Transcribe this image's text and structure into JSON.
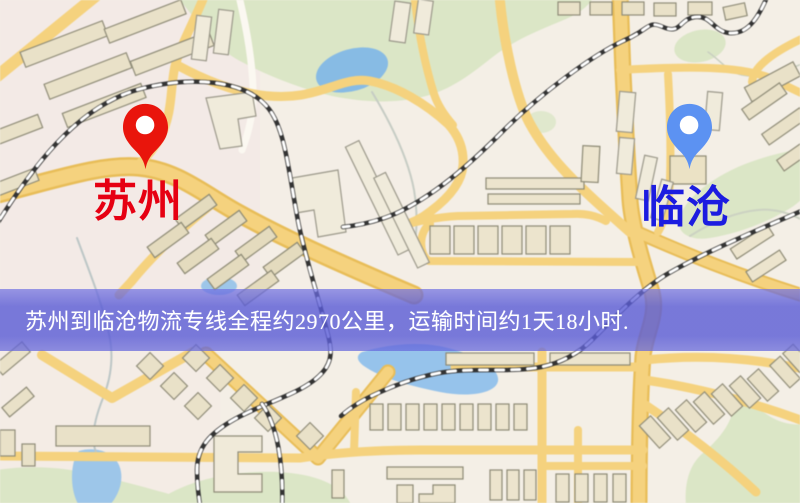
{
  "map": {
    "kind": "road-map",
    "colors": {
      "background": "#f4efe6",
      "road": "#f6d27b",
      "road_casing": "#e9bd55",
      "minor_road": "#fbf8f1",
      "park": "#dbe6c5",
      "water": "#8fc0e8",
      "building_fill": "#e9e1c7",
      "building_outline": "#8f8c77",
      "railway": "#333333"
    }
  },
  "markers": {
    "origin": {
      "label": "苏州",
      "label_color": "#e60012",
      "pin_color": "#e9150c",
      "icon": "red-map-pin-icon"
    },
    "destination": {
      "label": "临沧",
      "label_color": "#1c1ce0",
      "pin_color": "#5c92f2",
      "icon": "blue-map-pin-icon"
    }
  },
  "banner": {
    "text": "苏州到临沧物流专线全程约2970公里，运输时间约1天18小时.",
    "background_color": "#5d5fd9",
    "text_color": "#ffffff",
    "distance_km": "2970",
    "duration": "1天18小时"
  }
}
